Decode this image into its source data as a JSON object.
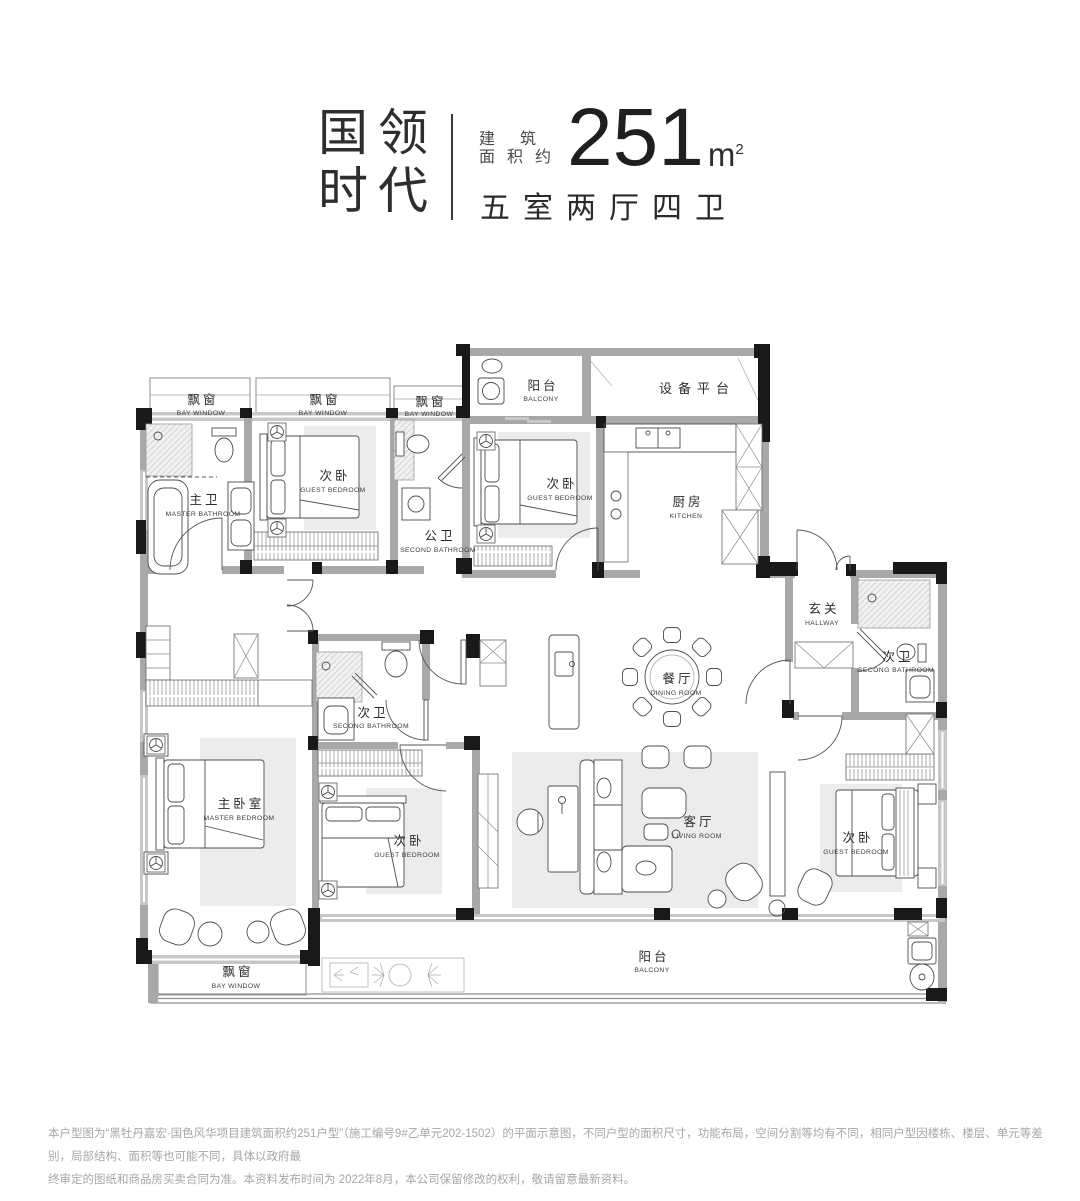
{
  "header": {
    "brand_line1": "国领",
    "brand_line2": "时代",
    "area_prefix_line1": "建筑",
    "area_prefix_line2": "面积约",
    "area_value": "251",
    "area_unit": "m",
    "area_unit_sup": "2",
    "layout_summary": "五室两厅四卫"
  },
  "room_labels": {
    "bay_window": {
      "zh": "飘窗",
      "en": "BAY WINDOW"
    },
    "master_bathroom": {
      "zh": "主卫",
      "en": "MASTER BATHROOM"
    },
    "guest_bedroom": {
      "zh": "次卧",
      "en": "GUEST BEDROOM"
    },
    "public_bathroom": {
      "zh": "公卫",
      "en": "SECOND BATHROOM"
    },
    "second_bathroom": {
      "zh": "次卫",
      "en": "SECONG BATHROOM"
    },
    "balcony": {
      "zh": "阳台",
      "en": "BALCONY"
    },
    "equipment_platform": {
      "zh": "设备平台"
    },
    "kitchen": {
      "zh": "厨房",
      "en": "KITCHEN"
    },
    "hallway": {
      "zh": "玄关",
      "en": "HALLWAY"
    },
    "dining_room": {
      "zh": "餐厅",
      "en": "DINING ROOM"
    },
    "living_room": {
      "zh": "客厅",
      "en": "LIVING ROOM"
    },
    "master_bedroom": {
      "zh": "主卧室",
      "en": "MASTER BEDROOM"
    }
  },
  "footer": {
    "disclaimer_line1": "本户型图为“黑牡丹嘉宏·国色风华项目建筑面积约251户型”（施工编号9#乙单元202-1502）的平面示意图，不同户型的面积尺寸，功能布局，空间分割等均有不同，相同户型因楼栋、楼层、单元等差别，局部结构、面积等也可能不同，具体以政府最",
    "disclaimer_line2": "终审定的图纸和商品房买卖合同为准。本资料发布时间为 2022年8月，本公司保留修改的权利，敬请留意最新资料。"
  }
}
